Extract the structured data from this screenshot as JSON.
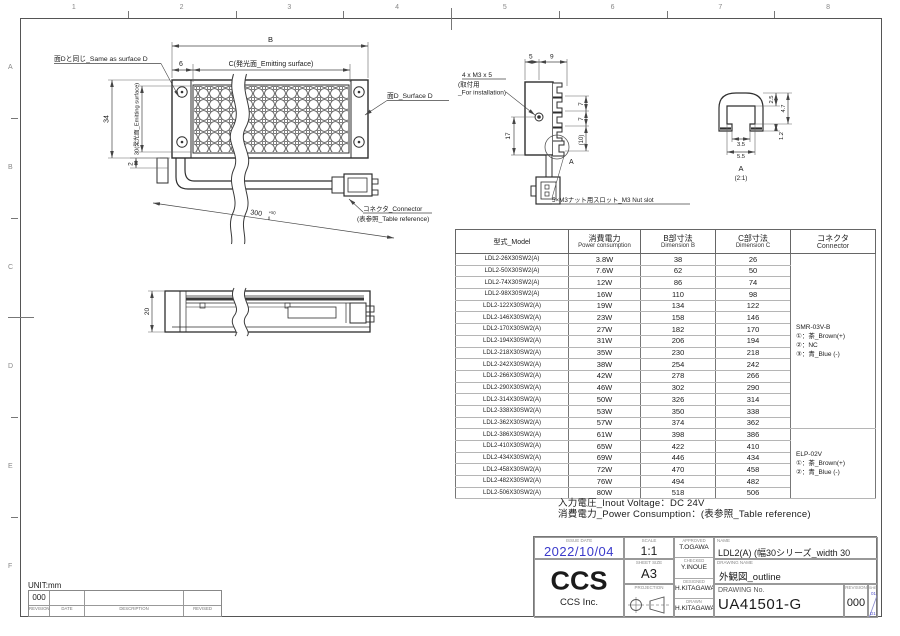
{
  "colors": {
    "accent_blue": "#3a3acb",
    "line": "#2e2e2e",
    "dim": "#444444"
  },
  "grid_refs": {
    "cols": [
      "1",
      "2",
      "3",
      "4",
      "5",
      "6",
      "7",
      "8"
    ],
    "rows": [
      "A",
      "B",
      "C",
      "D",
      "E",
      "F"
    ]
  },
  "front_view": {
    "same_as_d": "面Dと同じ_Same as surface D",
    "dim_b": "B",
    "dim_6": "6",
    "dim_c": "C(発光面_Emitting surface)",
    "dim_34": "34",
    "dim_30": "30(発光面_Emitting surface)",
    "dim_2": "2",
    "surface_d": "面D_Surface D",
    "cable_len": "300",
    "cable_tol_top": "+50",
    "cable_tol_bottom": "0",
    "connector_note_1": "コネクタ_Connector",
    "connector_note_2": "(表参照_Table reference)"
  },
  "end_view": {
    "dim_5": "5",
    "dim_9": "9",
    "dim_17": "17",
    "dim_7a": "7",
    "dim_7b": "7",
    "dim_10": "(10)",
    "screw_note_1": "4 x M3 x 5",
    "screw_note_2": "(取付用",
    "screw_note_3": "_For installation)",
    "detail_mark": "A",
    "nut_slot_note": "5×M3ナット用スロット_M3 Nut slot"
  },
  "detail_a": {
    "dim_25": "2.5",
    "dim_47": "4.7",
    "dim_12": "1.2",
    "dim_35": "3.5",
    "dim_55": "5.5",
    "label": "A",
    "scale": "(2:1)"
  },
  "side_view": {
    "dim_20": "20"
  },
  "spec_table": {
    "headers": {
      "model": "型式_Model",
      "power_jp": "消費電力",
      "power_en": "Power consumption",
      "b_jp": "B部寸法",
      "b_en": "Dimension B",
      "c_jp": "C部寸法",
      "c_en": "Dimension C",
      "conn_jp": "コネクタ",
      "conn_en": "Connector"
    },
    "rows": [
      {
        "model": "LDL2-26X30SW2(A)",
        "power": "3.8W",
        "b": "38",
        "c": "26"
      },
      {
        "model": "LDL2-50X30SW2(A)",
        "power": "7.6W",
        "b": "62",
        "c": "50"
      },
      {
        "model": "LDL2-74X30SW2(A)",
        "power": "12W",
        "b": "86",
        "c": "74"
      },
      {
        "model": "LDL2-98X30SW2(A)",
        "power": "16W",
        "b": "110",
        "c": "98"
      },
      {
        "model": "LDL2-122X30SW2(A)",
        "power": "19W",
        "b": "134",
        "c": "122"
      },
      {
        "model": "LDL2-146X30SW2(A)",
        "power": "23W",
        "b": "158",
        "c": "146"
      },
      {
        "model": "LDL2-170X30SW2(A)",
        "power": "27W",
        "b": "182",
        "c": "170"
      },
      {
        "model": "LDL2-194X30SW2(A)",
        "power": "31W",
        "b": "206",
        "c": "194"
      },
      {
        "model": "LDL2-218X30SW2(A)",
        "power": "35W",
        "b": "230",
        "c": "218"
      },
      {
        "model": "LDL2-242X30SW2(A)",
        "power": "38W",
        "b": "254",
        "c": "242"
      },
      {
        "model": "LDL2-266X30SW2(A)",
        "power": "42W",
        "b": "278",
        "c": "266"
      },
      {
        "model": "LDL2-290X30SW2(A)",
        "power": "46W",
        "b": "302",
        "c": "290"
      },
      {
        "model": "LDL2-314X30SW2(A)",
        "power": "50W",
        "b": "326",
        "c": "314"
      },
      {
        "model": "LDL2-338X30SW2(A)",
        "power": "53W",
        "b": "350",
        "c": "338"
      },
      {
        "model": "LDL2-362X30SW2(A)",
        "power": "57W",
        "b": "374",
        "c": "362"
      },
      {
        "model": "LDL2-386X30SW2(A)",
        "power": "61W",
        "b": "398",
        "c": "386"
      },
      {
        "model": "LDL2-410X30SW2(A)",
        "power": "65W",
        "b": "422",
        "c": "410"
      },
      {
        "model": "LDL2-434X30SW2(A)",
        "power": "69W",
        "b": "446",
        "c": "434"
      },
      {
        "model": "LDL2-458X30SW2(A)",
        "power": "72W",
        "b": "470",
        "c": "458"
      },
      {
        "model": "LDL2-482X30SW2(A)",
        "power": "76W",
        "b": "494",
        "c": "482"
      },
      {
        "model": "LDL2-506X30SW2(A)",
        "power": "80W",
        "b": "518",
        "c": "506"
      }
    ],
    "connector_smr": [
      "SMR-03V-B",
      "①：茶_Brown(+)",
      "②：NC",
      "③：青_Blue (-)"
    ],
    "connector_elp": [
      "ELP-02V",
      "①：茶_Brown(+)",
      "②：青_Blue (-)"
    ]
  },
  "notes": {
    "line1": "入力電圧_Inout Voltage：DC 24V",
    "line2": "消費電力_Power Consumption：(表参照_Table reference)"
  },
  "title_block": {
    "labels": {
      "issue_date": "ISSUE DATE",
      "scale": "SCALE",
      "approved": "APPROVED",
      "checked": "CHECKED",
      "designed": "DESIGNED",
      "drawn": "DRAWN",
      "sheet_size": "SHEET SIZE",
      "projection": "PROJECTION",
      "name": "NAME",
      "drawing_name": "DRAWING NAME",
      "drawing_no": "DRAWING No.",
      "revision": "REVISION",
      "sheet": "SHEET"
    },
    "values": {
      "issue_date": "2022/10/04",
      "scale": "1:1",
      "approved": "T.OGAWA",
      "checked": "Y.INOUE",
      "designed": "H.KITAGAWA",
      "drawn": "H.KITAGAWA",
      "sheet_size": "A3",
      "name": "LDL2(A) (幅30シリーズ_width 30 series)",
      "drawing_name": "外観図_outline",
      "drawing_no": "UA41501-G",
      "revision": "000",
      "rev_top": "01",
      "rev_bottom": "D1"
    },
    "logo_text": "CCS",
    "company": "CCS Inc."
  },
  "revision_strip": {
    "unit": "UNIT:mm",
    "value": "000",
    "headers": [
      "REVISION",
      "DATE",
      "DESCRIPTION",
      "REVISED"
    ]
  }
}
